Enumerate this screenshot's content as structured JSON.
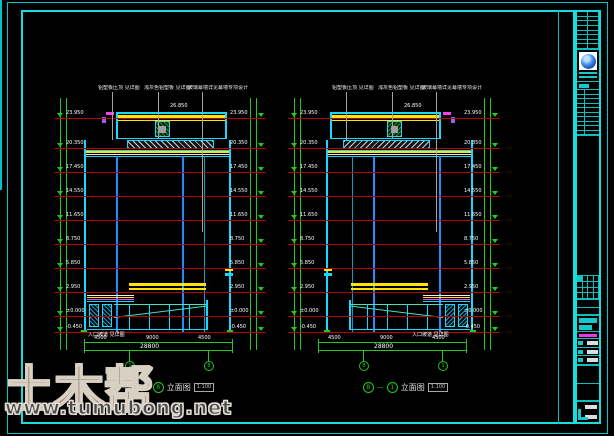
{
  "watermark": {
    "brand": "土木帮",
    "url": "www.tumubong.net"
  },
  "caption": {
    "dash": "—"
  },
  "levels": {
    "values": [
      "23.950",
      "20.350",
      "17.450",
      "14.550",
      "11.650",
      "8.750",
      "5.850",
      "2.950",
      "±0.000",
      "-0.450"
    ],
    "roof": "26.850"
  },
  "annotations": {
    "top_labels": [
      "铝塑板压顶 见详图",
      "浅灰色铝塑板 见详图",
      "玻璃幕墙详见幕墙专项设计"
    ],
    "entrance_label": "入口坡道 见详图"
  },
  "dimensions": {
    "segments": [
      "4500",
      "9000",
      "4500"
    ],
    "total": "28800"
  },
  "drawings": [
    {
      "bubble_left": "1",
      "bubble_right": "8",
      "title": "立面图",
      "scale": "1:100"
    },
    {
      "bubble_left": "8",
      "bubble_right": "1",
      "title": "立面图",
      "scale": "1:100"
    }
  ],
  "titleblock": {
    "logo": "design-institute-seal"
  },
  "colors": {
    "frame": "#17dede",
    "grid": "#1ecb1e",
    "level_line": "#b40000",
    "accent_yellow": "#ffe500",
    "building": "#18d8ff",
    "mullion": "#2090ff",
    "magenta": "#ff3df0"
  }
}
